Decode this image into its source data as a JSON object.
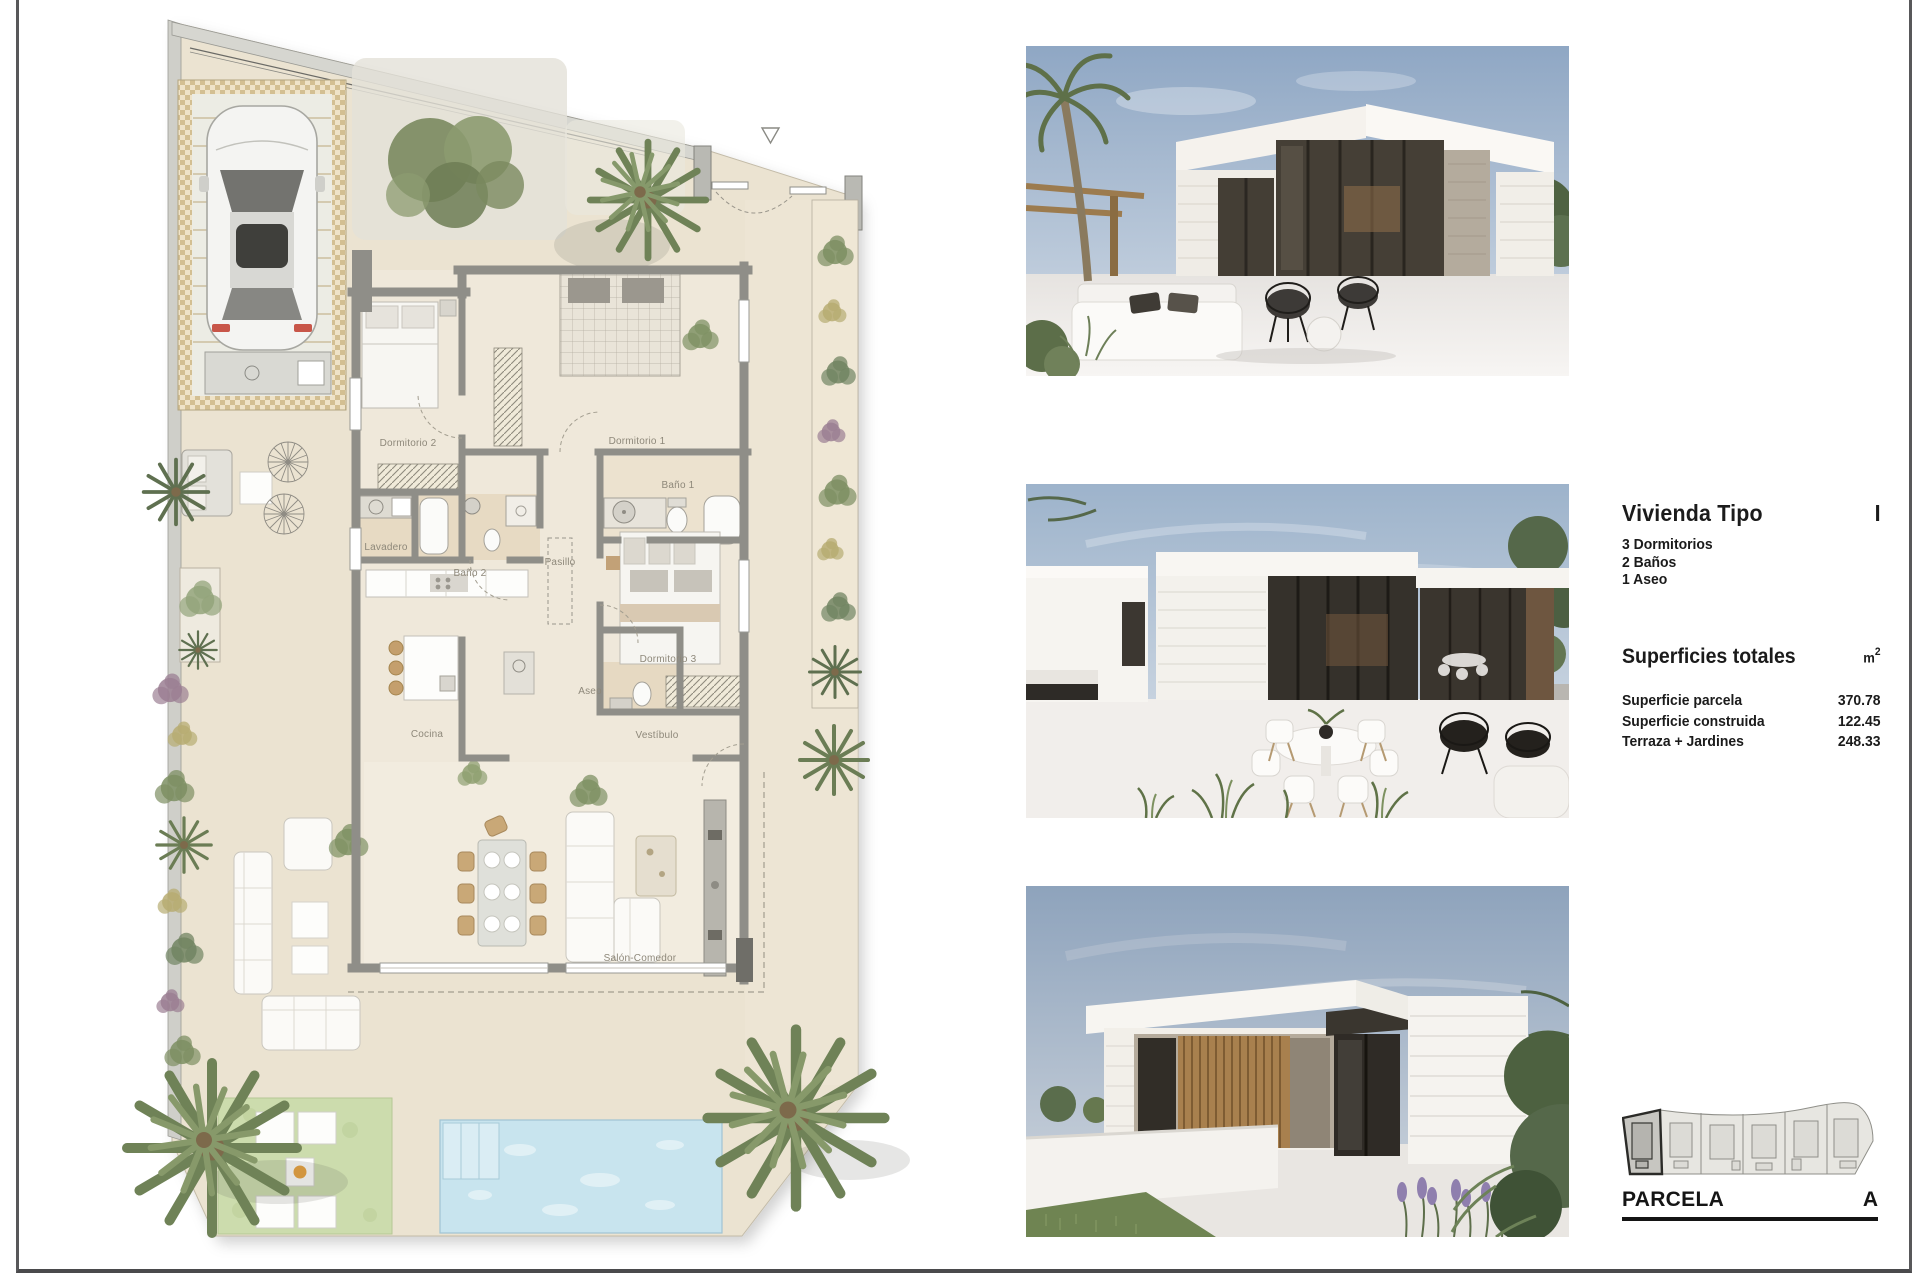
{
  "info_panel": {
    "title": "Vivienda Tipo",
    "type_code": "I",
    "features": [
      "3 Dormitorios",
      "2 Baños",
      "1 Aseo"
    ],
    "surfaces_heading": "Superficies totales",
    "unit": "m",
    "unit_exponent": "2",
    "surfaces": [
      {
        "label": "Superficie parcela",
        "value": "370.78"
      },
      {
        "label": "Superficie construida",
        "value": "122.45"
      },
      {
        "label": "Terraza + Jardines",
        "value": "248.33"
      }
    ]
  },
  "parcel_panel": {
    "label": "PARCELA",
    "value": "A",
    "lot_count": 6,
    "highlighted_lot_index": 0
  },
  "floor_plan": {
    "rooms": [
      {
        "label": "Dormitorio 2"
      },
      {
        "label": "Dormitorio 1"
      },
      {
        "label": "Baño 1"
      },
      {
        "label": "Lavadero"
      },
      {
        "label": "Baño 2"
      },
      {
        "label": "Pasillo"
      },
      {
        "label": "Dormitorio 3"
      },
      {
        "label": "Aseo"
      },
      {
        "label": "Cocina"
      },
      {
        "label": "Vestíbulo"
      },
      {
        "label": "Salón-Comedor"
      }
    ]
  },
  "colors": {
    "frame_border": "#58585a",
    "plot_fill": "#ebe3d1",
    "wall_gray": "#8f8e88",
    "garage_checker": "#d8c69e",
    "pool_blue": "#c8e4ee",
    "lawn_green": "#ccdcad",
    "vegetation_green": "#7d8f63",
    "wood_brown": "#a8804e",
    "sky_blue": "#9db3cb",
    "accent_orange": "#e8a23c"
  }
}
